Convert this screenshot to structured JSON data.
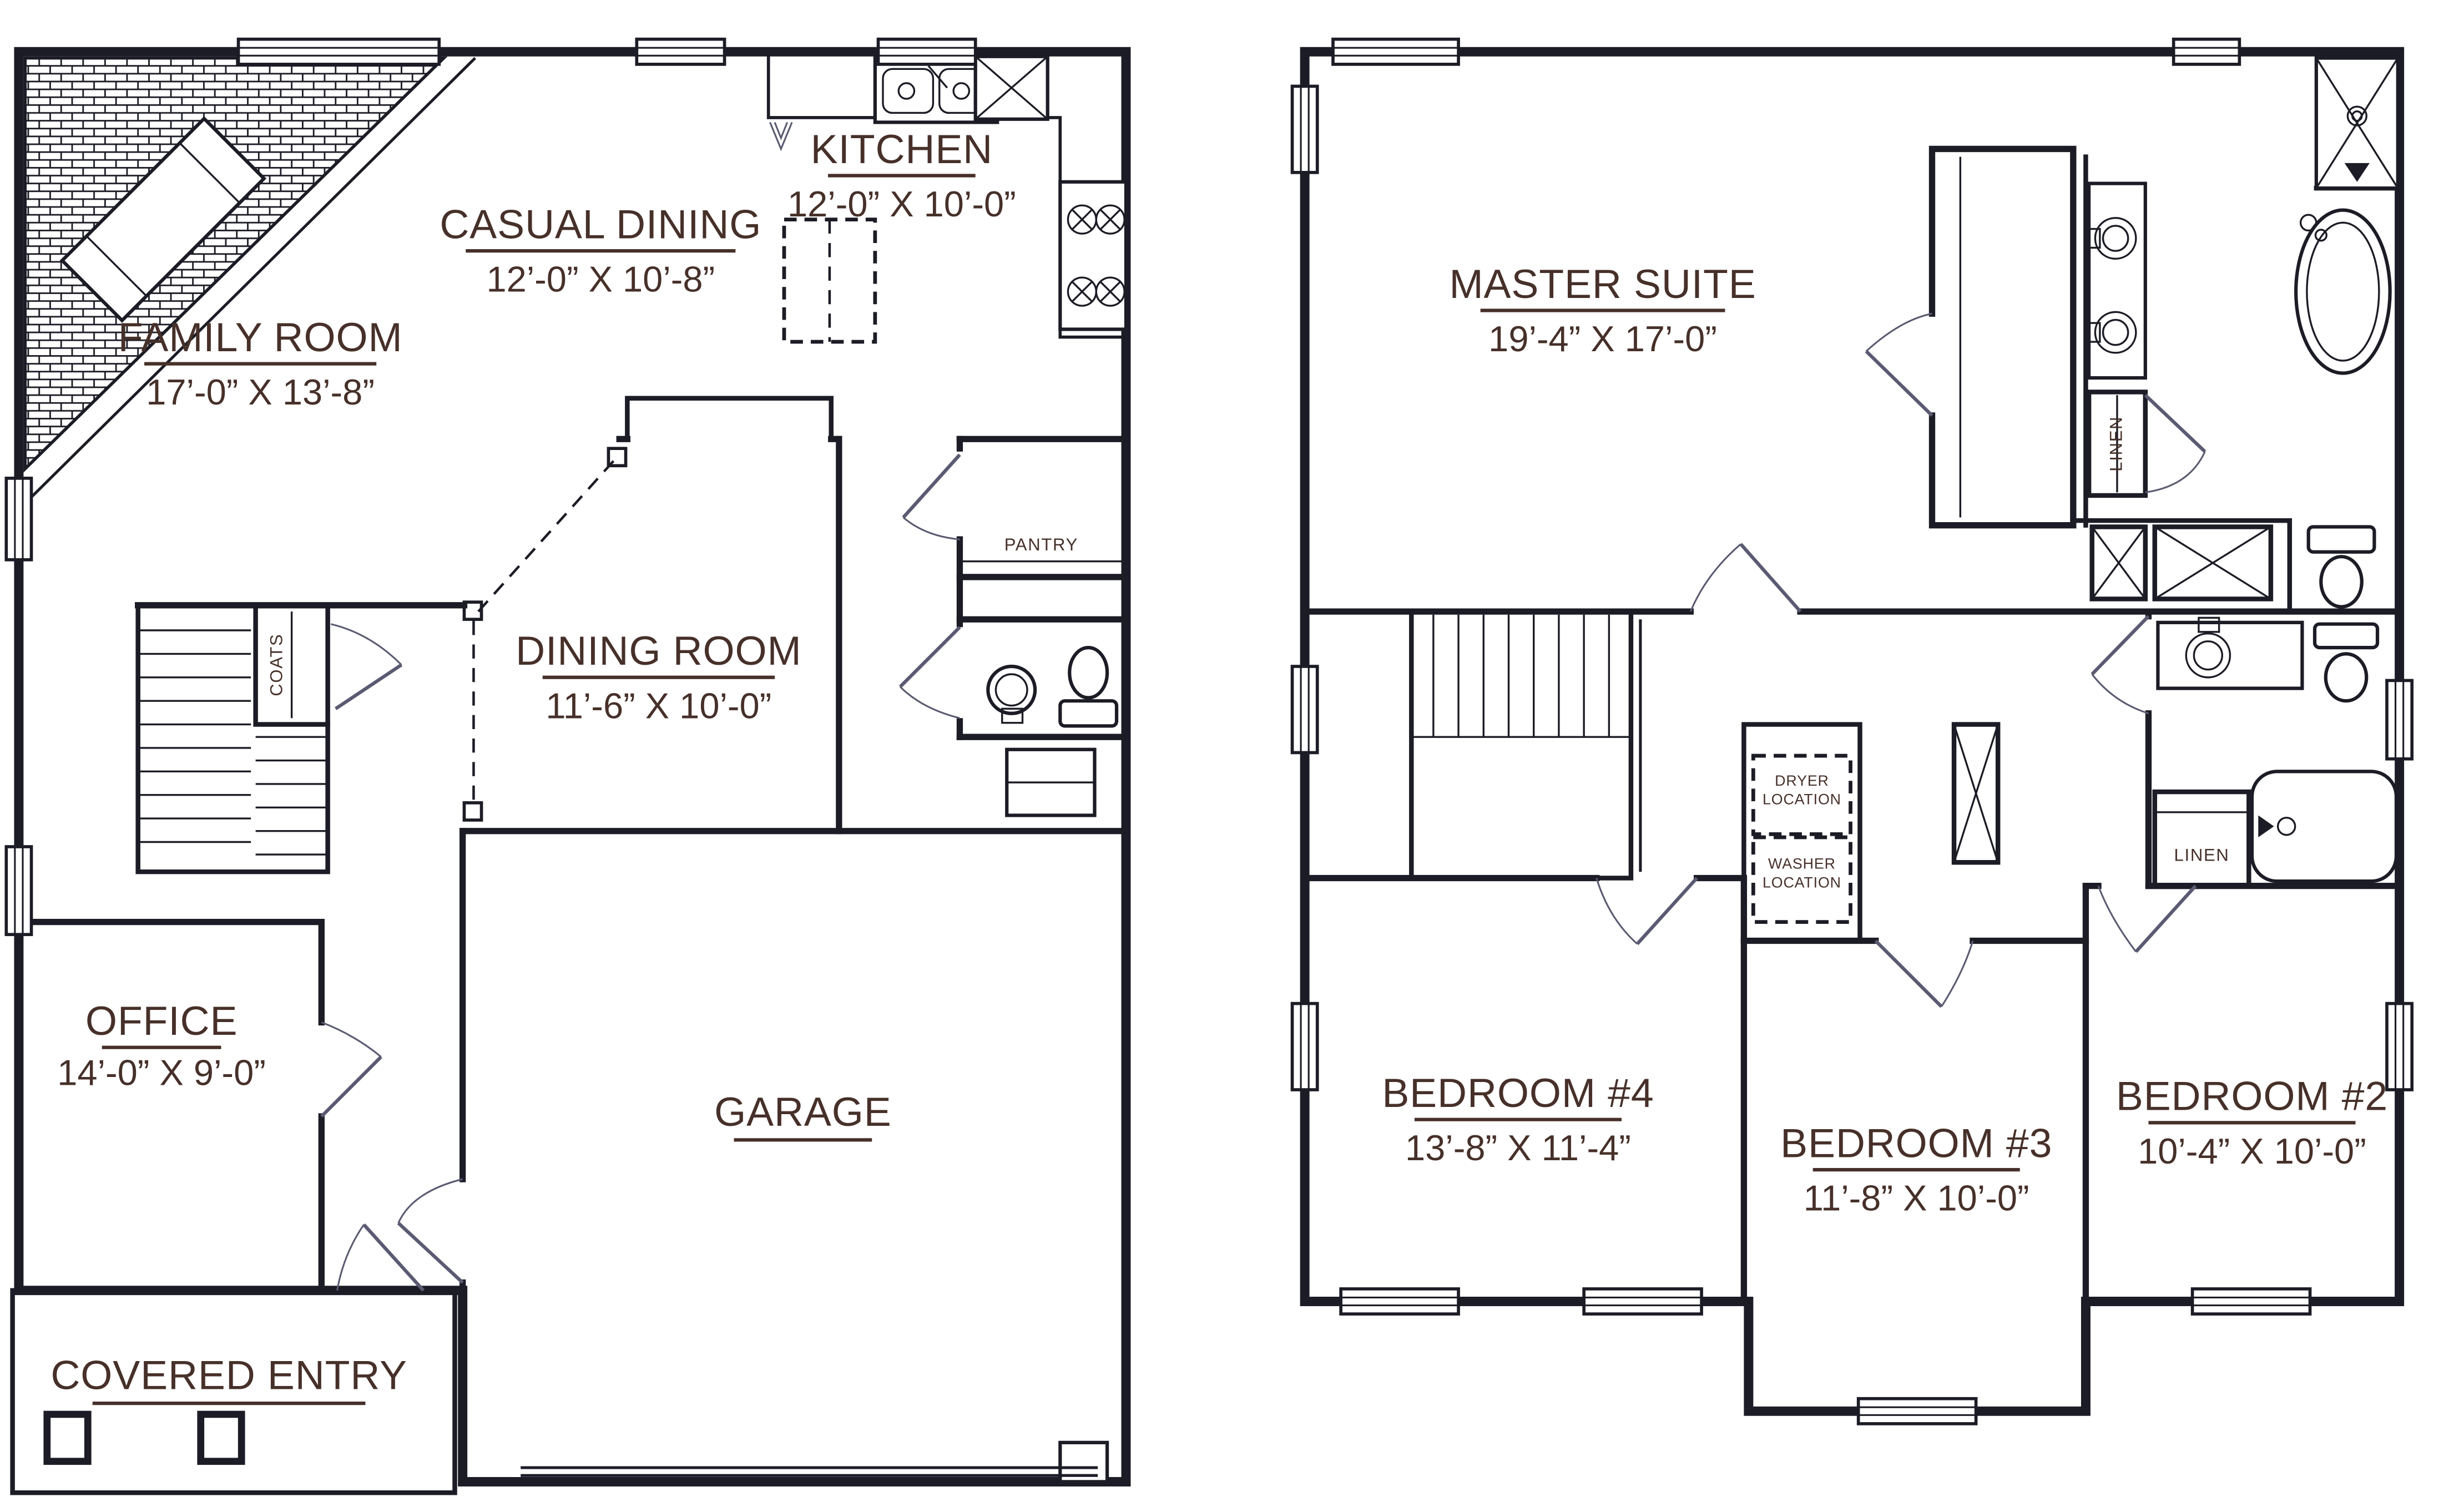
{
  "sheet": {
    "type": "two-story residential floor plan",
    "background": "#ffffff"
  },
  "colors": {
    "wall": "#1c1c26",
    "label_text": "#463029",
    "door_swing": "#5a5a72"
  },
  "first_floor": {
    "rooms": [
      {
        "id": "family-room",
        "name": "FAMILY ROOM",
        "dims": "17’-0” X 13’-8”"
      },
      {
        "id": "casual-dining",
        "name": "CASUAL DINING",
        "dims": "12’-0” X 10’-8”"
      },
      {
        "id": "kitchen",
        "name": "KITCHEN",
        "dims": "12’-0” X 10’-0”"
      },
      {
        "id": "dining-room",
        "name": "DINING ROOM",
        "dims": "11’-6” X 10’-0”"
      },
      {
        "id": "office",
        "name": "OFFICE",
        "dims": "14’-0” X 9’-0”"
      },
      {
        "id": "garage",
        "name": "GARAGE",
        "dims": ""
      },
      {
        "id": "covered-entry",
        "name": "COVERED ENTRY",
        "dims": ""
      }
    ],
    "labels": {
      "pantry": "PANTRY",
      "coats": "COATS"
    }
  },
  "second_floor": {
    "rooms": [
      {
        "id": "master-suite",
        "name": "MASTER SUITE",
        "dims": "19’-4” X 17’-0”"
      },
      {
        "id": "bedroom-4",
        "name": "BEDROOM #4",
        "dims": "13’-8” X 11’-4”"
      },
      {
        "id": "bedroom-3",
        "name": "BEDROOM #3",
        "dims": "11’-8” X 10’-0”"
      },
      {
        "id": "bedroom-2",
        "name": "BEDROOM #2",
        "dims": "10’-4” X 10’-0”"
      }
    ],
    "labels": {
      "linen_master": "LINEN",
      "linen_hall": "LINEN",
      "dryer_line1": "DRYER",
      "dryer_line2": "LOCATION",
      "washer_line1": "WASHER",
      "washer_line2": "LOCATION"
    }
  }
}
